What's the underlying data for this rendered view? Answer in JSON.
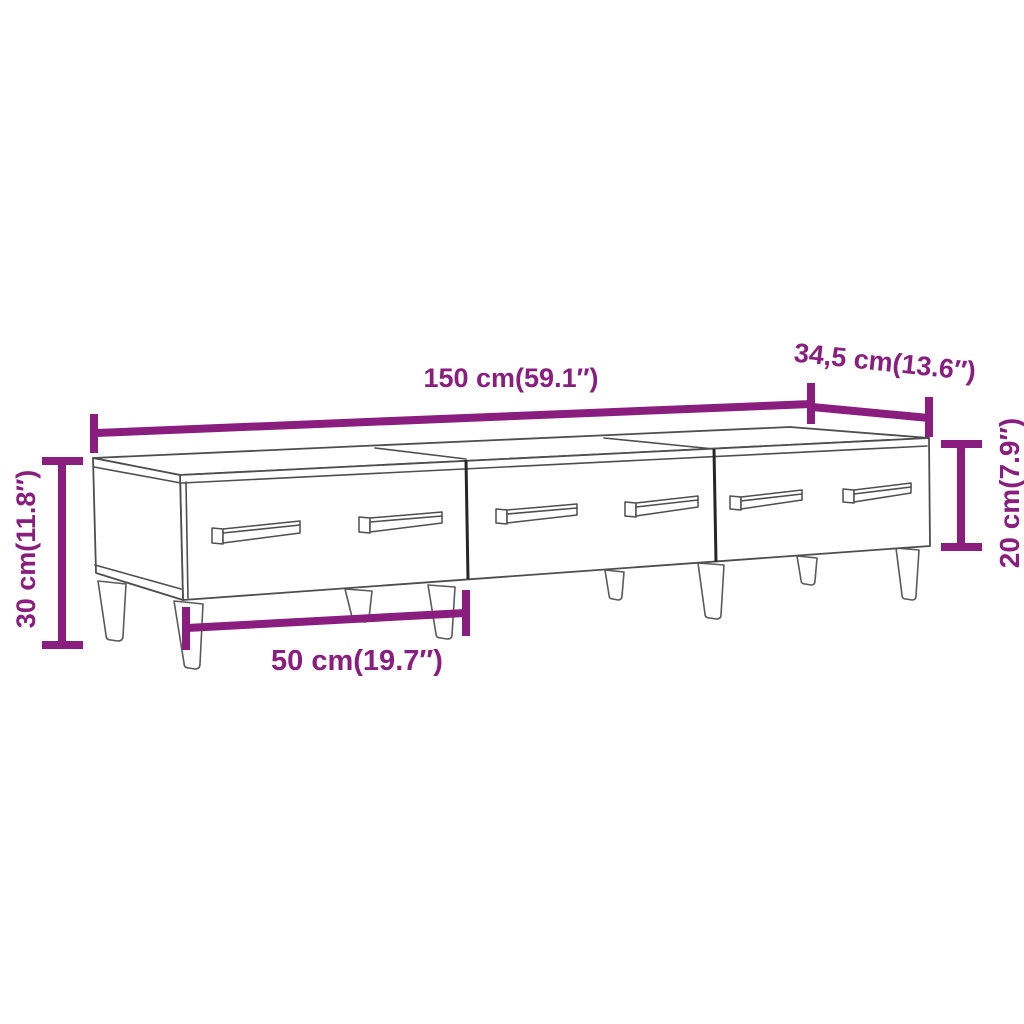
{
  "page": {
    "background_color": "#ffffff"
  },
  "diagram": {
    "type": "product-dimension-diagram",
    "subject": "TV cabinet with 3 drawers, 6 bar handles and 8 tapered legs",
    "accent_color": "#8a1e7e",
    "outline_color": "#4e4e4e",
    "drawer_count": 3,
    "handle_count": 6,
    "leg_count": 8,
    "labels": {
      "overall_width": "150 cm(59.1″)",
      "depth": "34,5 cm(13.6″)",
      "overall_height": "30 cm(11.8″)",
      "drawer_front_height": "20 cm(7.9″)",
      "drawer_width": "50 cm(19.7″)"
    }
  }
}
